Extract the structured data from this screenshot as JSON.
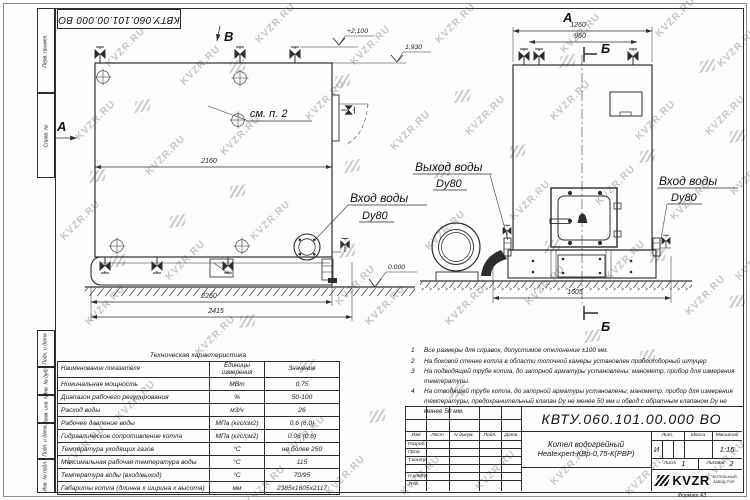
{
  "sheet": {
    "doc_number": "КВТУ.060.101.00.000  ВО",
    "format_label": "Формат  А3"
  },
  "watermark": {
    "text": "KVZR.RU"
  },
  "margin": {
    "labels": [
      "Перв. примен.",
      "Справ. №",
      "Подп. и дата",
      "Инв. № дубл.",
      "Взам. инв. №",
      "Подп. и дата",
      "Инв. № подл."
    ]
  },
  "views": {
    "marker_b": "В",
    "marker_a": "А",
    "front_label": "А",
    "section_b_top": "Б",
    "section_b_bottom": "Б",
    "see_note": "см. п. 2",
    "dims": {
      "d2160": "2160",
      "d2260": "2260",
      "d2415": "2415",
      "d1260": "1260",
      "d960": "960",
      "d1605": "1605"
    },
    "elev": {
      "top_left": "+2,100",
      "top_right": "1,930",
      "ground": "0.000"
    },
    "labels": {
      "inlet_side": "Вход воды",
      "inlet_side_dn": "Dy80",
      "outlet": "Выход воды",
      "outlet_dn": "Dy80",
      "inlet_front": "Вход воды",
      "inlet_front_dn": "Dy80"
    }
  },
  "notes": {
    "items": [
      {
        "num": "1",
        "text": "Все размеры для справок, допустимое отклонение ±100 мм."
      },
      {
        "num": "2",
        "text": "На боковой стенке котла в области топочной камеры установлен пробоотборный штуцер"
      },
      {
        "num": "3",
        "text": "На  подводящей трубе котла, до запорной арматуры установлены: манометр, прибор для измерения температуры."
      },
      {
        "num": "4",
        "text": "На отводящей трубе котла, до запорной арматуры установлены: манометр, прибор для измерения температуры, предохранительный клапан Dy не менее 50 мм и обвод с обратным клапаном Dy не менее 50 мм."
      }
    ]
  },
  "tech_table": {
    "title": "Техническая характеристика",
    "headers": [
      "Наименование показателя",
      "Единицы измерения",
      "Значение"
    ],
    "rows": [
      {
        "name": "Номинальная мощность",
        "unit": "МВт",
        "value": "0,75"
      },
      {
        "name": "Диапазон рабочего регулирования",
        "unit": "%",
        "value": "50-100"
      },
      {
        "name": "Расход воды",
        "unit": "м3/ч",
        "value": "26"
      },
      {
        "name": "Рабочее давление воды",
        "unit": "МПа (кгс/см2)",
        "value": "0,6 (6,0)"
      },
      {
        "name": "Гидравлическое сопротивление котла",
        "unit": "МПа (кгс/см2)",
        "value": "0,06 (0,6)"
      },
      {
        "name": "Температура уходящих газов",
        "unit": "°С",
        "value": "не более 250"
      },
      {
        "name": "Максимальная рабочая температура воды",
        "unit": "°С",
        "value": "115"
      },
      {
        "name": "Температура воды (вход/выход)",
        "unit": "°С",
        "value": "70/95"
      },
      {
        "name": "Габариты котла (длинна х ширина х высота)",
        "unit": "мм",
        "value": "2385х1605х2117"
      }
    ]
  },
  "title_block": {
    "cols": [
      "Изм",
      "Лист",
      "N докум.",
      "Подп.",
      "Дата"
    ],
    "rows": [
      "Разраб.",
      "Пров.",
      "Т.контр",
      "",
      "Н.контр",
      "Утв."
    ],
    "name_line1": "Котел водогрейный",
    "name_line2": "Heatexpert-КВр-0,75-К(РВР)",
    "lit_label": "Лит.",
    "mass_label": "Масса",
    "scale_label": "Масштаб",
    "lit_value": "И",
    "scale_value": "1:15",
    "sheet_label": "Лист",
    "sheet_value": "1",
    "sheets_label": "Листов",
    "sheets_value": "2",
    "logo_text": "KVZR",
    "logo_sub1": "КОТЕЛЬНЫЙ",
    "logo_sub2": "ЗАВОД РЭП"
  }
}
